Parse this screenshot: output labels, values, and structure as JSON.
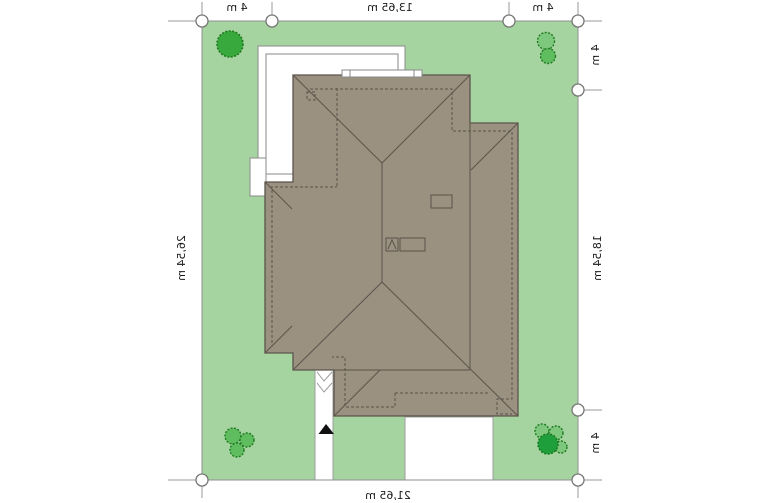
{
  "labels": {
    "top": [
      "4 m",
      "13,65 m",
      "4 m"
    ],
    "right": [
      "4 m",
      "18,54 m",
      "4 m"
    ],
    "left": "26,54 m",
    "bottom": "21,65 m"
  },
  "colors": {
    "lawn": "#a6d4a0",
    "roof": "#9a9181",
    "roofline": "#5c544b",
    "plotline": "#8f8f8f",
    "pathline": "#9e9e9e",
    "terraceline": "#8a8a8a",
    "marker": "#777777",
    "tick": "#999999",
    "steps": "#9a9a9a",
    "treedeep": "#1f9e3c",
    "treedark": "#38a93c",
    "treemid": "#5fbc5f",
    "treelight": "#7dc87d",
    "treestroke": "#1e7a22",
    "arrow": "#111111",
    "text": "#1a1a1a",
    "white": "#ffffff"
  }
}
